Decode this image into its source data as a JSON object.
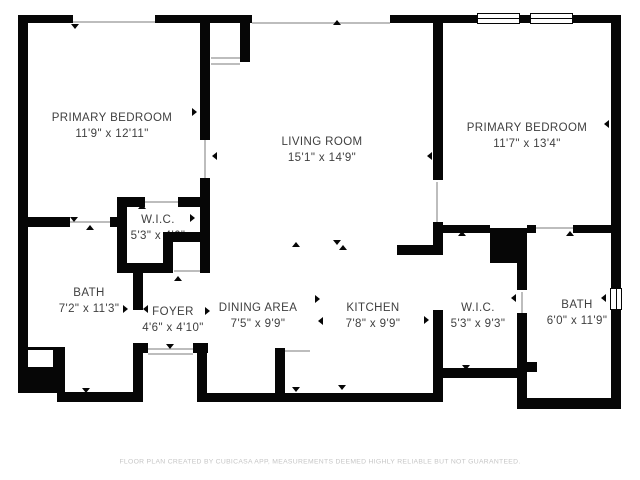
{
  "rooms": [
    {
      "name": "PRIMARY BEDROOM",
      "dims": "11'9\" x 12'11\""
    },
    {
      "name": "LIVING ROOM",
      "dims": "15'1\" x 14'9\""
    },
    {
      "name": "PRIMARY BEDROOM",
      "dims": "11'7\" x 13'4\""
    },
    {
      "name": "W.I.C.",
      "dims": "5'3\" x 4'6\""
    },
    {
      "name": "BATH",
      "dims": "7'2\" x 11'3\""
    },
    {
      "name": "FOYER",
      "dims": "4'6\" x 4'10\""
    },
    {
      "name": "DINING AREA",
      "dims": "7'5\" x 9'9\""
    },
    {
      "name": "KITCHEN",
      "dims": "7'8\" x 9'9\""
    },
    {
      "name": "W.I.C.",
      "dims": "5'3\" x 9'3\""
    },
    {
      "name": "BATH",
      "dims": "6'0\" x 11'9\""
    }
  ],
  "footer": "FLOOR PLAN CREATED BY CUBICASA APP, MEASUREMENTS DEEMED HIGHLY RELIABLE BUT NOT GUARANTEED.",
  "colors": {
    "wall": "#060606",
    "label_text": "#3f3f3f",
    "opening_line": "#bdbdbd",
    "footer_text": "#c6c6c6",
    "background": "#ffffff"
  }
}
